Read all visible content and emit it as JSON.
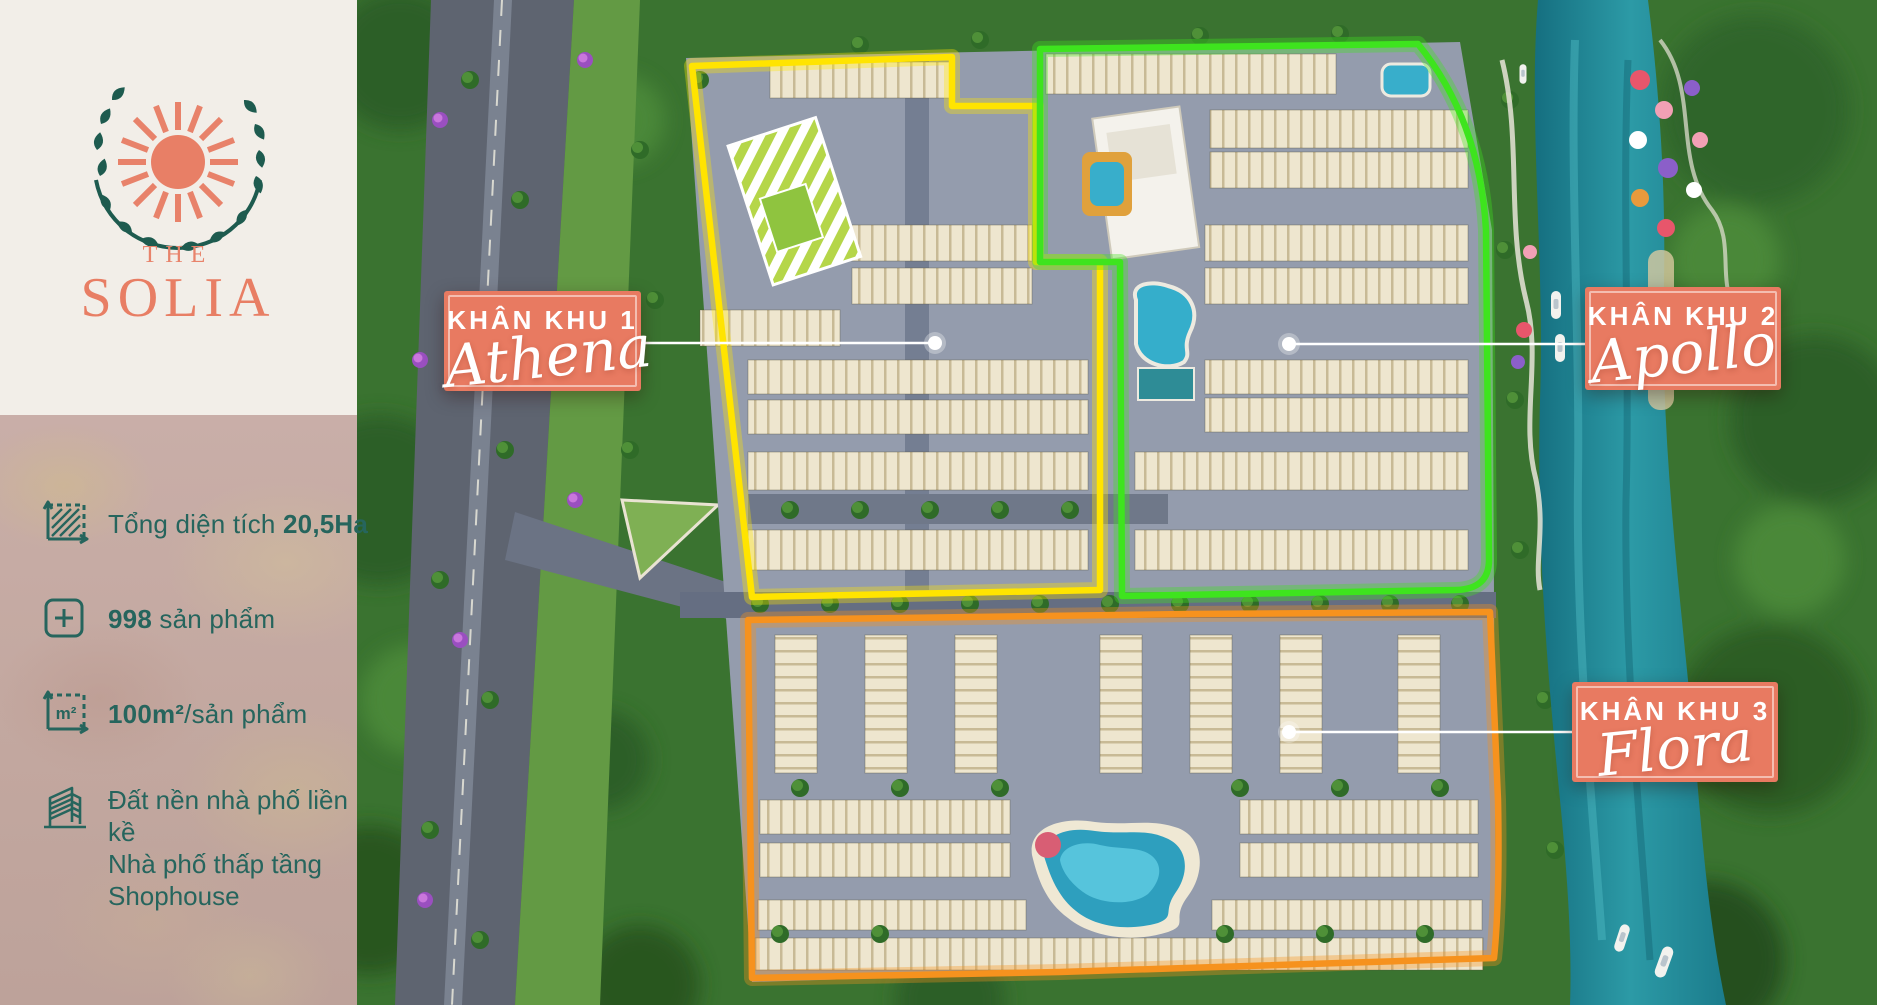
{
  "sidebar": {
    "brand": {
      "word_top": "THE",
      "word_main": "SOLIA"
    },
    "icons": {
      "m2_label": "m²"
    },
    "stats": {
      "area": {
        "prefix": "Tổng diện tích ",
        "bold": "20,5Ha",
        "suffix": ""
      },
      "units": {
        "prefix": "",
        "bold": "998",
        "suffix": " sản phẩm"
      },
      "size": {
        "prefix": "",
        "bold": "100m²",
        "suffix": "/sản phẩm"
      },
      "types": {
        "lines": [
          "Đất nền nhà phố liền kề",
          "Nhà phố thấp tầng",
          "Shophouse"
        ]
      }
    }
  },
  "map": {
    "zones": [
      {
        "label": "KHÂN KHU 1",
        "name": "Athena",
        "outline_color": "#FFE400"
      },
      {
        "label": "KHÂN KHU 2",
        "name": "Apollo",
        "outline_color": "#3EE41E"
      },
      {
        "label": "KHÂN KHU 3",
        "name": "Flora",
        "outline_color": "#F6921E"
      }
    ]
  },
  "colors": {
    "label_box": "#E87A61",
    "brand_salmon": "#E8836B",
    "wreath_green": "#1E5B4F",
    "stat_teal": "#26655D",
    "cream": "#F2EEE8"
  }
}
